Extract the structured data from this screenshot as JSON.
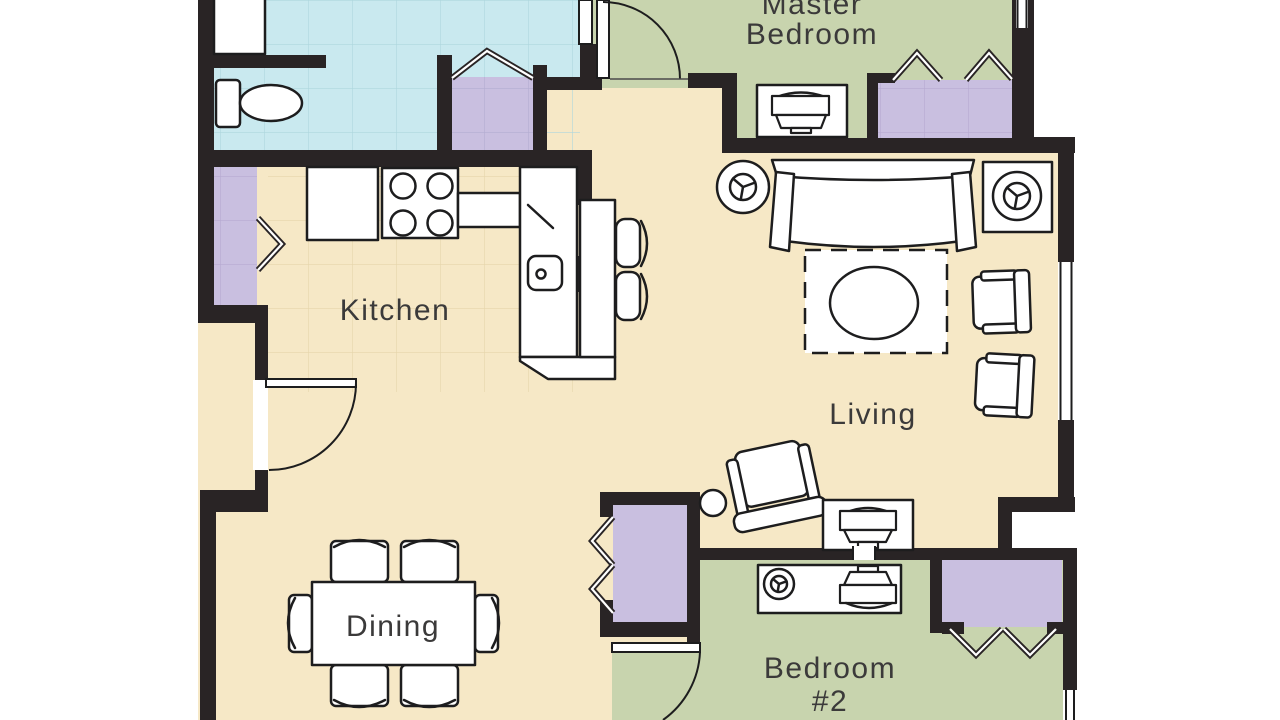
{
  "diagram_type": "apartment-floor-plan",
  "rooms": {
    "master_bedroom": {
      "label_line1": "Master",
      "label_line2": "Bedroom",
      "floor_color": "#c8d4ae"
    },
    "kitchen": {
      "label": "Kitchen",
      "floor_color": "#f6e8c6"
    },
    "living": {
      "label": "Living",
      "floor_color": "#f6e8c6"
    },
    "dining": {
      "label": "Dining",
      "floor_color": "#f6e8c6"
    },
    "bedroom2": {
      "label_line1": "Bedroom",
      "label_line2": "#2",
      "floor_color": "#c8d4ae"
    },
    "bathroom": {
      "floor_color": "#c9e9ef"
    },
    "closets": {
      "floor_color": "#c9bfe0"
    }
  },
  "colors": {
    "walls": "#292425",
    "background": "#ffffff",
    "furniture_outline": "#1d1d1e",
    "label_text": "#3b3a3a"
  },
  "furniture_icons": [
    "sofa",
    "area-rug",
    "coffee-table",
    "armchair",
    "tilted-armchair",
    "round-end-table",
    "square-end-table",
    "table-lamp",
    "tv-console",
    "dining-table",
    "dining-chair",
    "refrigerator",
    "stove",
    "kitchen-sink",
    "kitchen-counter",
    "bar-counter",
    "bar-stool",
    "toilet",
    "bathroom-vanity",
    "desk",
    "round-side-table",
    "closet-bifold-door",
    "door-swing",
    "window"
  ]
}
